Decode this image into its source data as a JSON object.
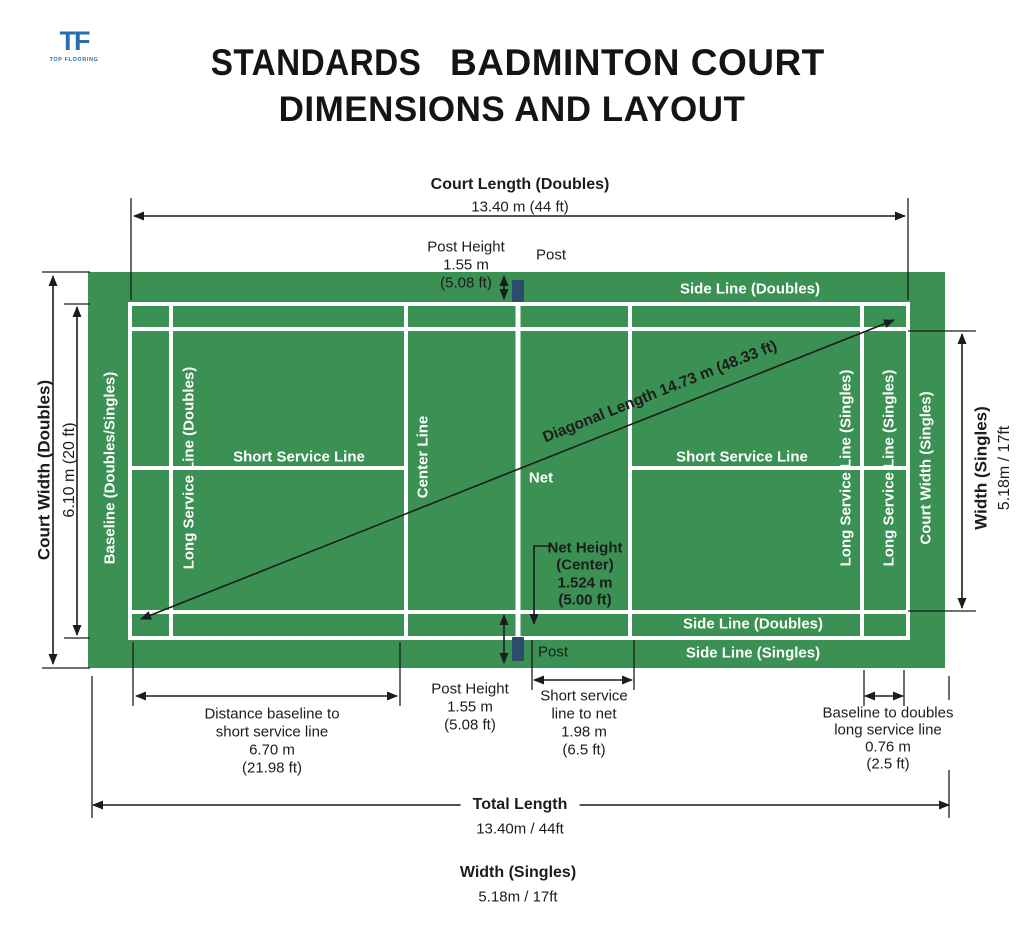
{
  "logo": {
    "monogram": "TF",
    "caption": "TOP FLOORING"
  },
  "title": {
    "line1_prefix": "STANDARDS",
    "line1_main": "BADMINTON COURT",
    "line2": "DIMENSIONS AND LAYOUT"
  },
  "colors": {
    "court_green": "#3a9153",
    "line_white": "#ffffff",
    "post_navy": "#2c4b6d",
    "ink": "#1c1c1c",
    "logo_blue": "#2b6cab"
  },
  "top": {
    "court_length_label": "Court Length (Doubles)",
    "court_length_value": "13.40 m (44 ft)",
    "post_height": [
      "Post Height",
      "1.55 m",
      "(5.08 ft)"
    ],
    "post": "Post"
  },
  "left": {
    "court_width_label": "Court Width (Doubles)",
    "court_width_value": "6.10 m (20 ft)"
  },
  "right": {
    "width_singles_label": "Width (Singles)",
    "width_singles_value": "5.18m / 17ft"
  },
  "court": {
    "side_line_doubles_top": "Side Line (Doubles)",
    "side_line_doubles_bottom": "Side Line (Doubles)",
    "side_line_singles_bottom": "Side Line (Singles)",
    "short_service_left": "Short Service Line",
    "short_service_right": "Short Service Line",
    "center_line": "Center Line",
    "net": "Net",
    "baseline": "Baseline (Doubles/Singles)",
    "long_service_doubles": "Long Service Line (Doubles)",
    "long_service_singles_1": "Long Service Line (Singles)",
    "long_service_singles_2": "Long Service Line (Singles)",
    "court_width_singles": "Court Width (Singles)",
    "diagonal": "Diagonal Length 14.73 m (48.33 ft)"
  },
  "net_height": [
    "Net Height",
    "(Center)",
    "1.524 m",
    "(5.00 ft)"
  ],
  "bottom": {
    "post": "Post",
    "post_height": [
      "Post Height",
      "1.55 m",
      "(5.08 ft)"
    ],
    "short_service_to_net": [
      "Short service",
      "line to net",
      "1.98 m",
      "(6.5 ft)"
    ],
    "distance_baseline": [
      "Distance baseline to",
      "short service line",
      "6.70 m",
      "(21.98 ft)"
    ],
    "baseline_to_doubles": [
      "Baseline to doubles",
      "long service line",
      "0.76 m",
      "(2.5 ft)"
    ],
    "total_length_label": "Total Length",
    "total_length_value": "13.40m / 44ft",
    "width_singles_label": "Width (Singles)",
    "width_singles_value": "5.18m / 17ft"
  }
}
